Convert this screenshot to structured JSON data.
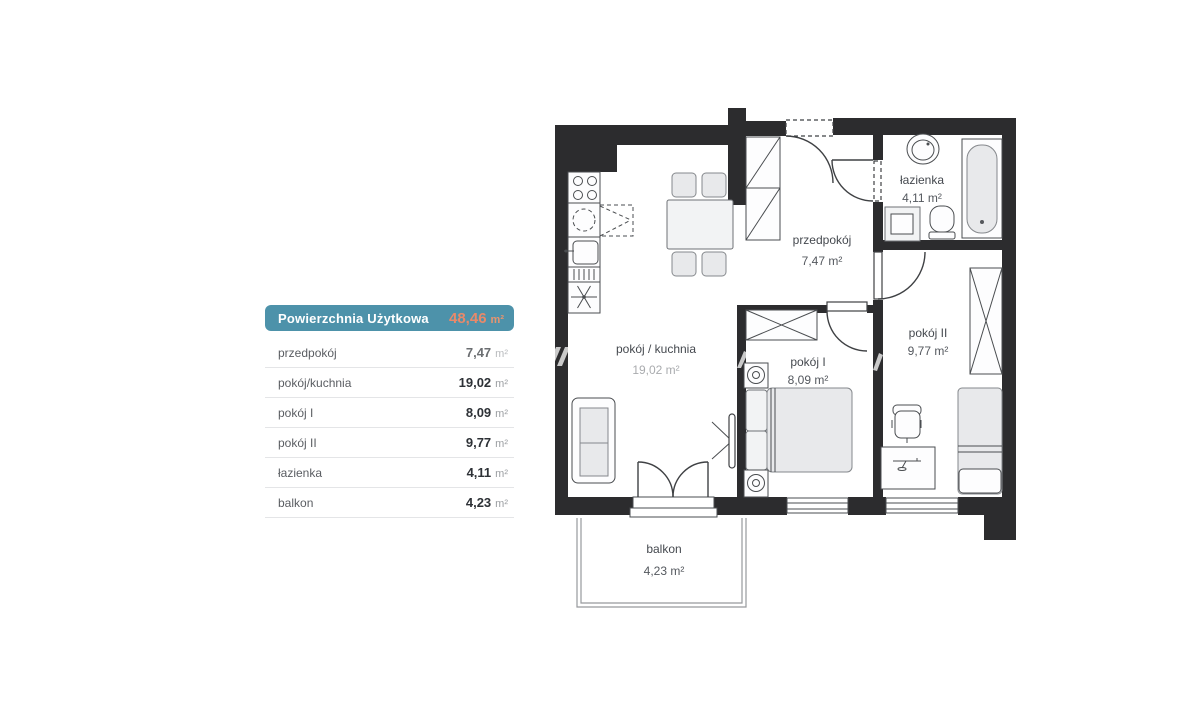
{
  "summary_table": {
    "header": {
      "label": "Powierzchnia Użytkowa",
      "value": "48,46",
      "unit": "m²"
    },
    "rows": [
      {
        "label": "przedpokój",
        "value": "7,47",
        "unit": "m²"
      },
      {
        "label": "pokój/kuchnia",
        "value": "19,02",
        "unit": "m²"
      },
      {
        "label": "pokój I",
        "value": "8,09",
        "unit": "m²"
      },
      {
        "label": "pokój II",
        "value": "9,77",
        "unit": "m²"
      },
      {
        "label": "łazienka",
        "value": "4,11",
        "unit": "m²"
      },
      {
        "label": "balkon",
        "value": "4,23",
        "unit": "m²"
      }
    ]
  },
  "floor_plan": {
    "rooms": [
      {
        "name": "pokój / kuchnia",
        "area": "19,02 m²"
      },
      {
        "name": "przedpokój",
        "area": "7,47 m²"
      },
      {
        "name": "łazienka",
        "area": "4,11 m²"
      },
      {
        "name": "pokój I",
        "area": "8,09 m²"
      },
      {
        "name": "pokój II",
        "area": "9,77 m²"
      },
      {
        "name": "balkon",
        "area": "4,23 m²"
      }
    ],
    "furniture": [
      "stove",
      "kitchen-sink",
      "fridge",
      "dining-table",
      "chairs",
      "sofa",
      "tv",
      "hall-wardrobe",
      "washbasin",
      "bathtub",
      "washing-machine",
      "toilet",
      "double-bed",
      "nightstands",
      "wardrobe",
      "single-bed",
      "desk",
      "desk-chair",
      "entrance-door",
      "interior-doors",
      "french-balcony-door",
      "windows",
      "balcony-railing"
    ]
  },
  "colors": {
    "wall": "#2c2c2e",
    "header_bg": "#4d92aa",
    "header_text": "#ffffff",
    "header_value": "#e8896a",
    "furniture_fill": "#e8e9eb",
    "room_label": "#45494f",
    "divider": "#e4e5e7"
  }
}
